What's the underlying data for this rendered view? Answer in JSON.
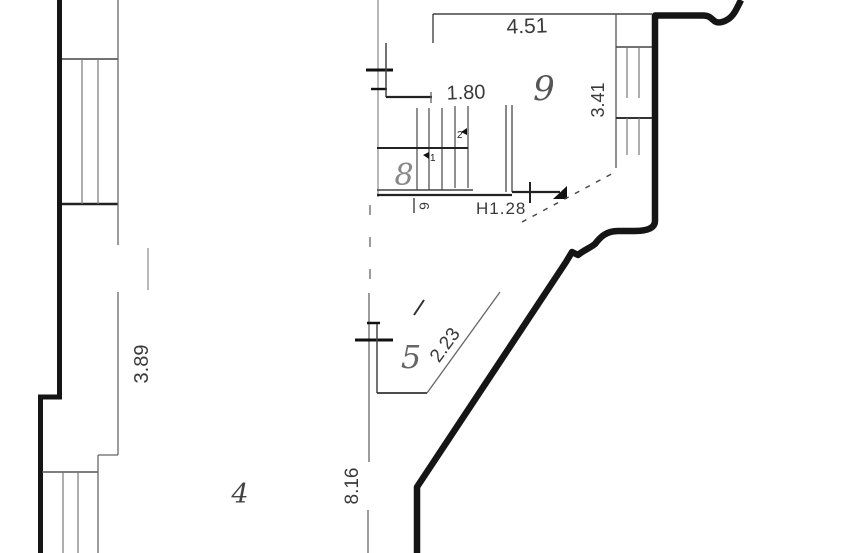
{
  "dimensions": {
    "d451": "4.51",
    "d180": "1.80",
    "d341": "3.41",
    "d389": "3.89",
    "d128": "H1.28",
    "d223": "2.23",
    "d816": "8.16"
  },
  "rooms": {
    "r9": "9",
    "r8": "8",
    "r5": "5",
    "r4": "4"
  },
  "marks": {
    "opening": "9",
    "flight_up": "2",
    "flight_down": "1"
  },
  "colors": {
    "wall": "#151515",
    "thin_line": "#555555",
    "dim_text": "#3a3a3a",
    "room_text": "#666666",
    "background": "#ffffff"
  }
}
